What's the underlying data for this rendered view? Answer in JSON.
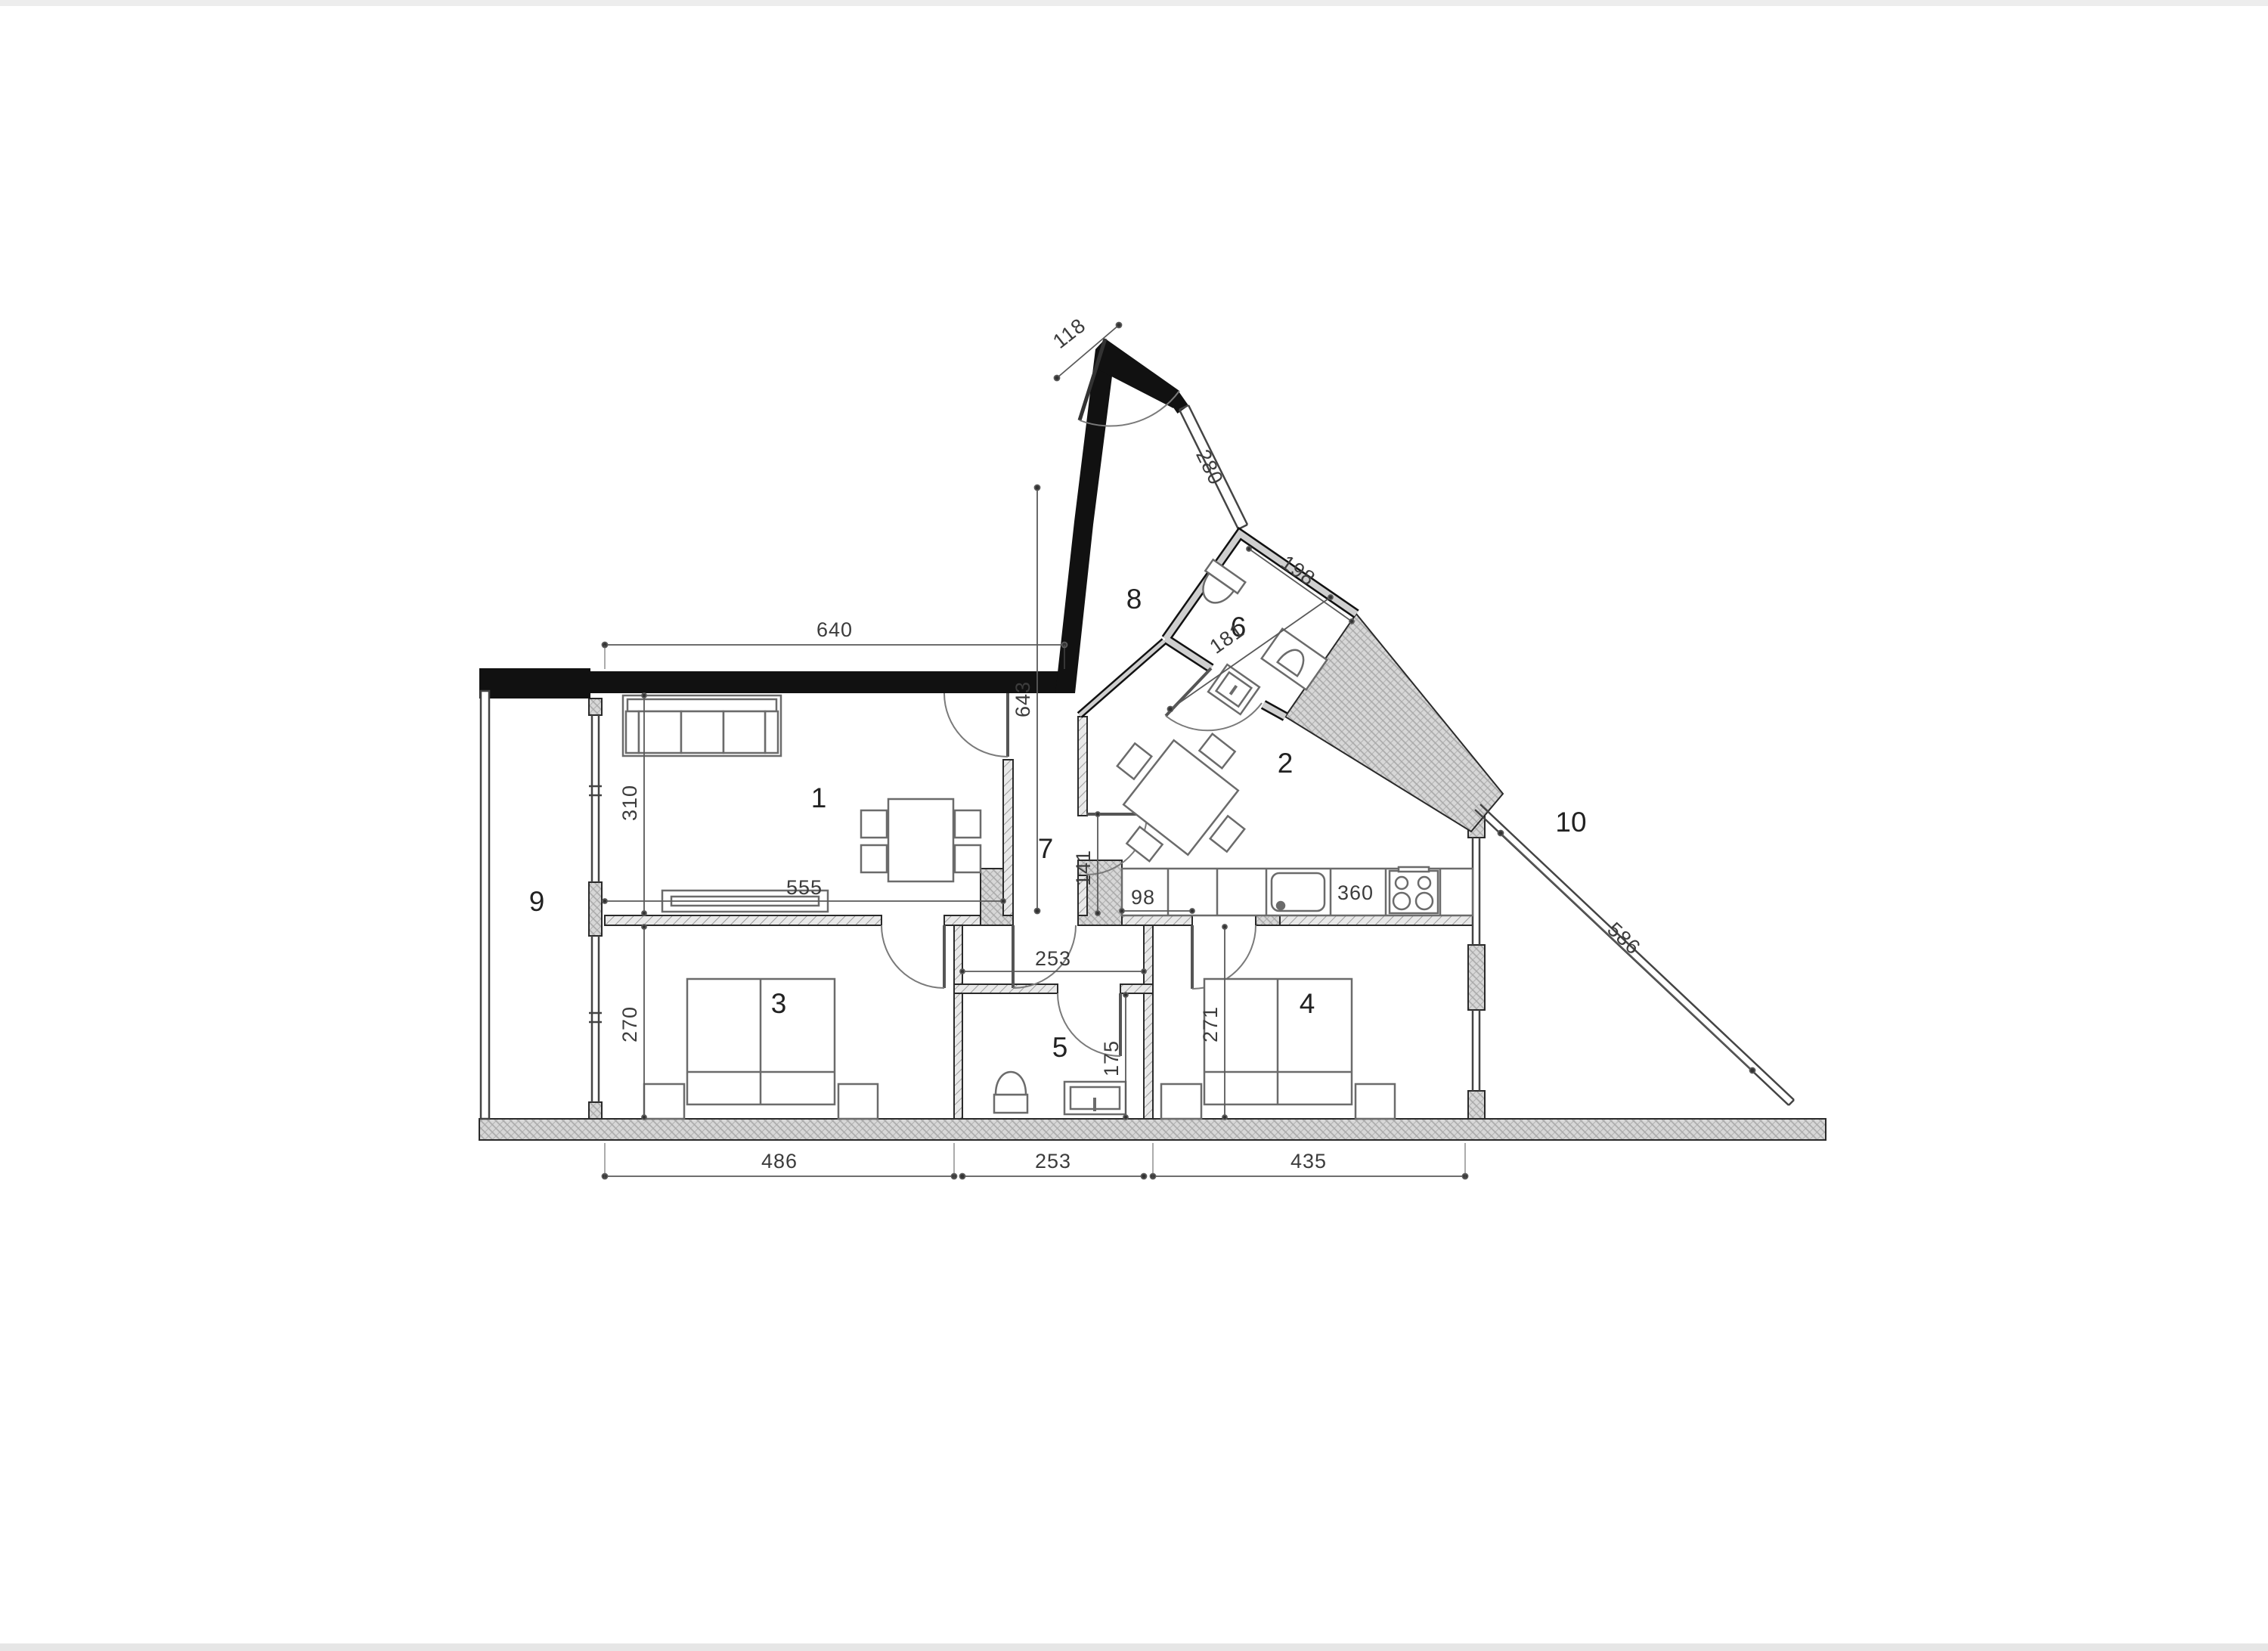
{
  "page": {
    "background": "#ffffff",
    "top_strip_color": "#ededed",
    "bottom_strip_color": "#e6e6e6"
  },
  "plan": {
    "type": "apartment floor plan",
    "wall_colors": {
      "exterior_black": "#111111",
      "hatched_fill": "#dcdcdc",
      "line": "#2a2a2a"
    },
    "rooms": {
      "living": "1",
      "kitchen": "2",
      "bedroom_left": "3",
      "bedroom_right": "4",
      "wc": "5",
      "bathroom": "6",
      "hallway": "7",
      "entry": "8",
      "balcony": "9",
      "terrace": "10"
    },
    "dimensions": {
      "entrance_door": "118",
      "top_wall": "640",
      "hall_length": "643",
      "living_left_height": "310",
      "living_bottom_width": "555",
      "passage_width": "98",
      "kitchen_door_height": "141",
      "bath_diagonal": "181",
      "bath_wall": "198",
      "entry_window": "280",
      "kitchen_counter": "360",
      "terrace_edge": "586",
      "wc_top_width": "253",
      "wc_height": "175",
      "bedroom_right_height": "271",
      "bedroom_left_height": "270",
      "bottom_left": "486",
      "bottom_middle": "253",
      "bottom_right": "435"
    }
  }
}
